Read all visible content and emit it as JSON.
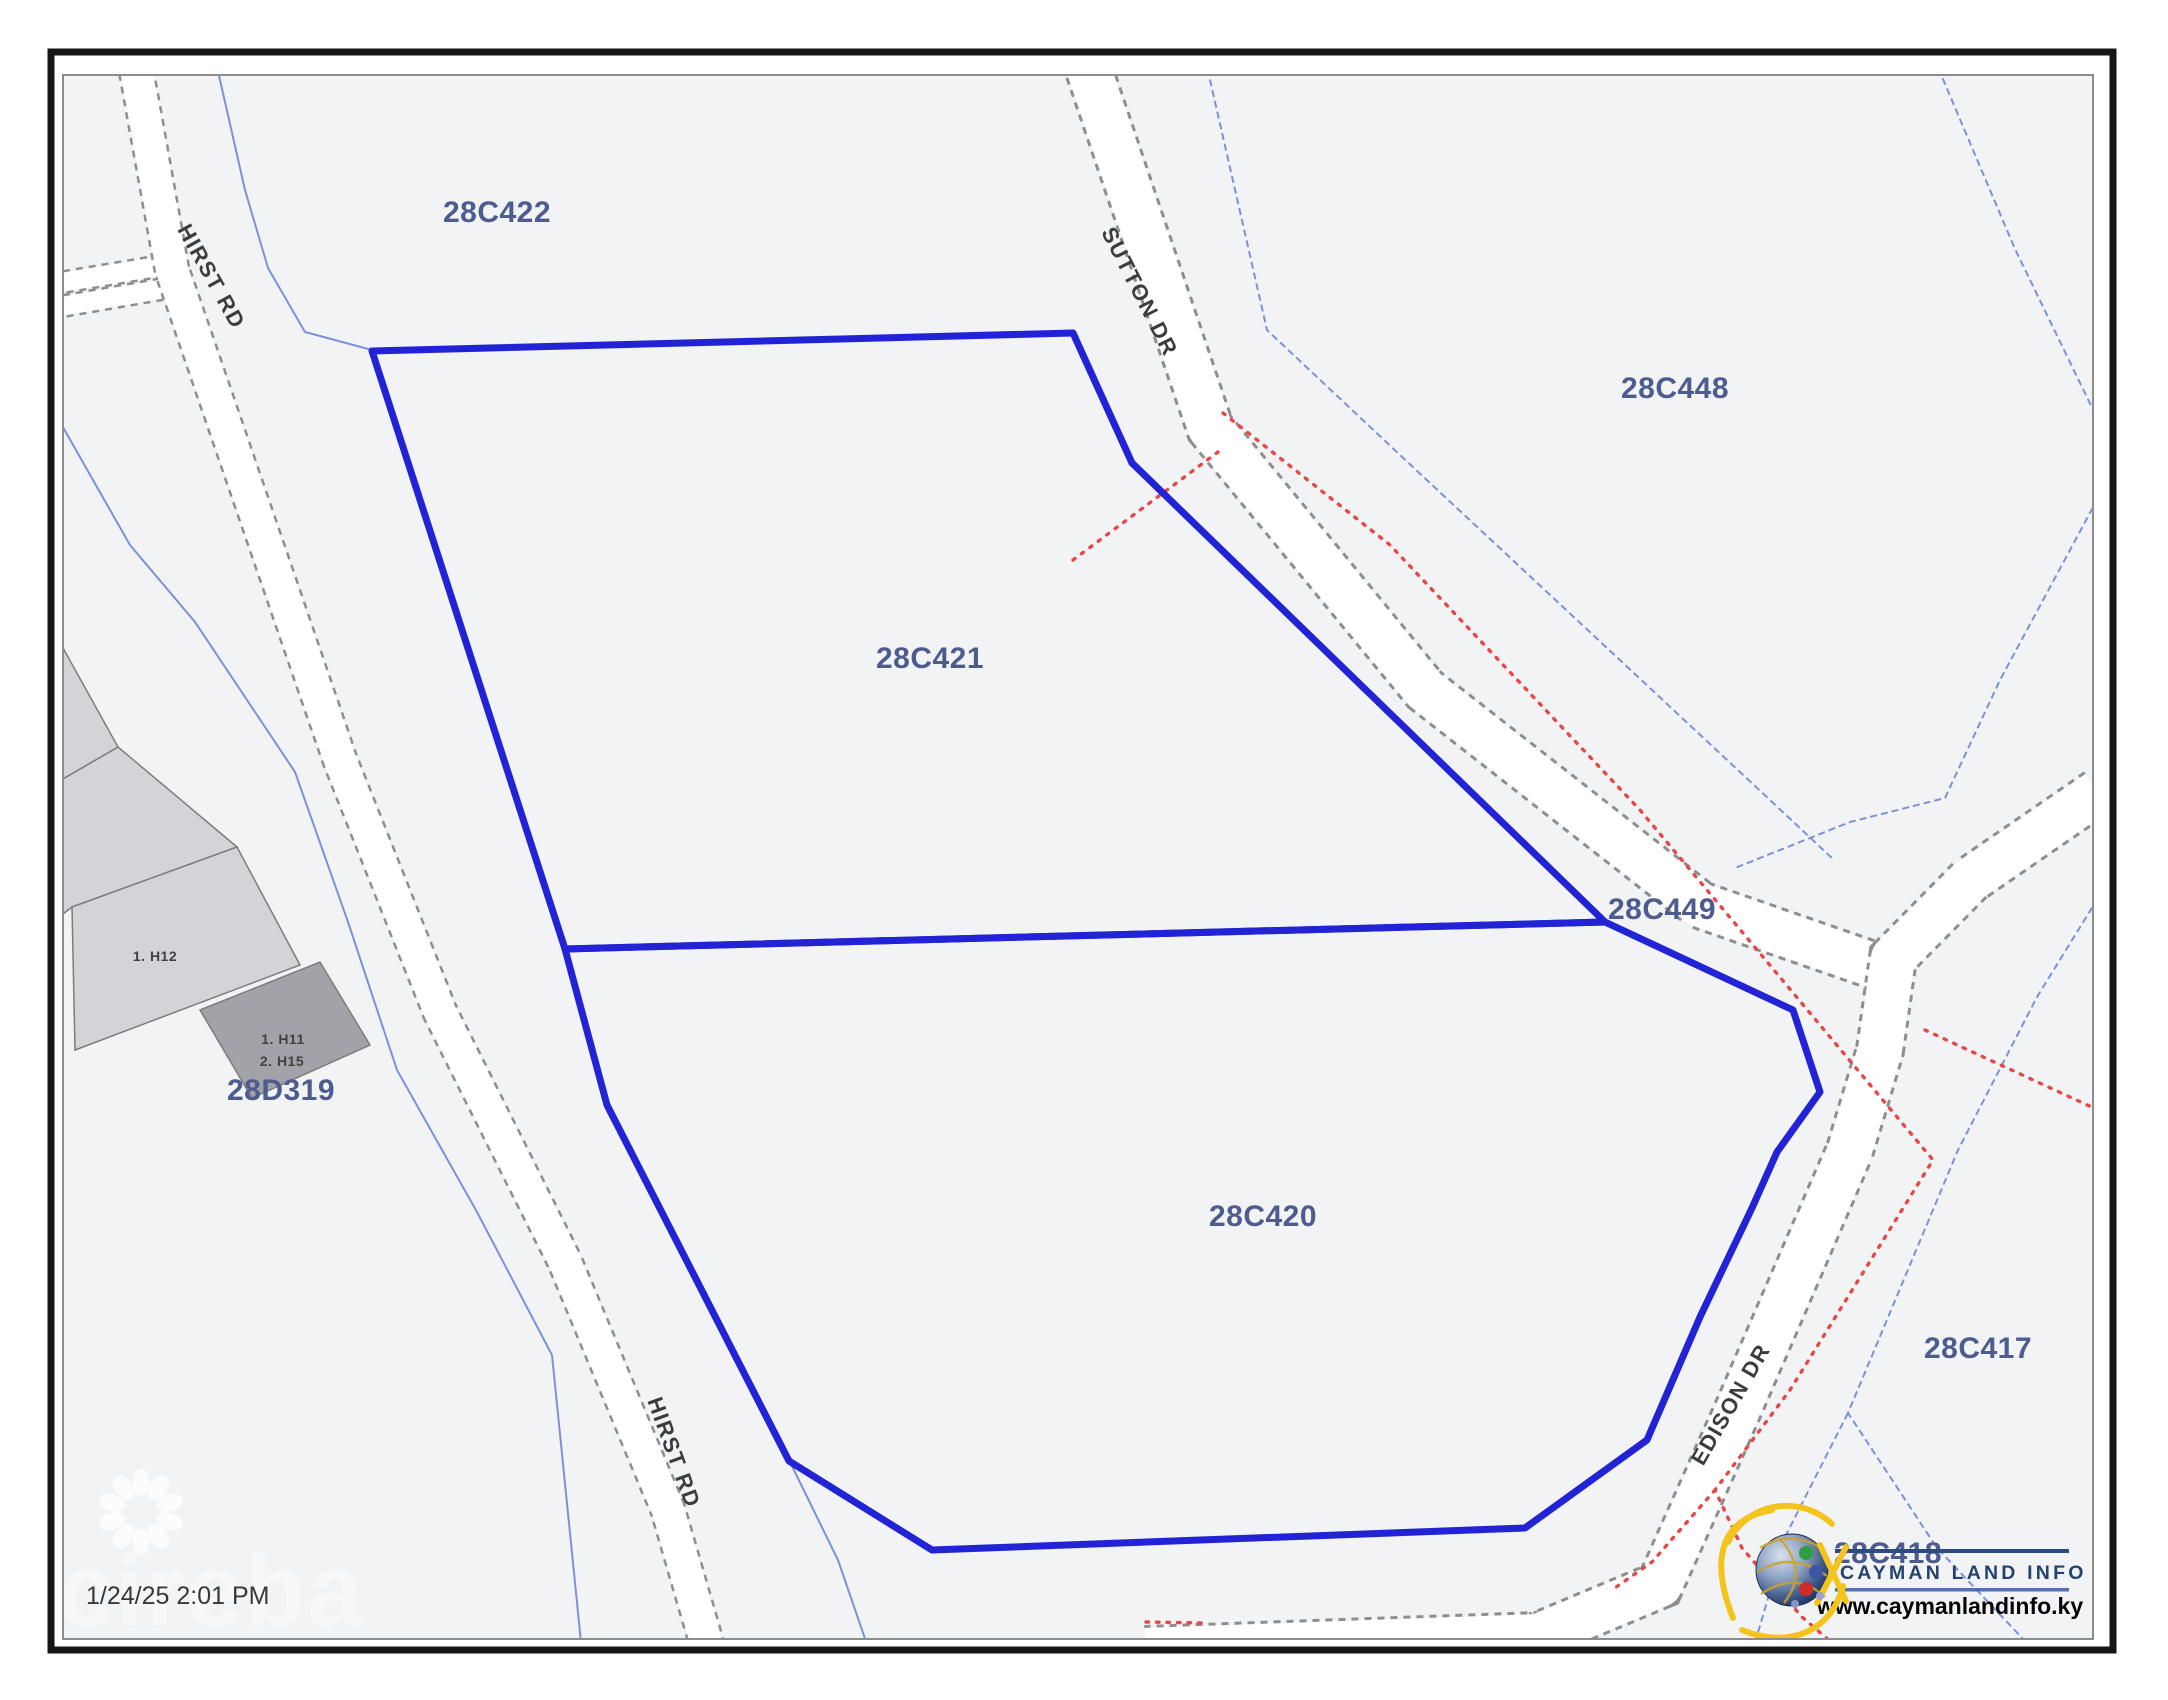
{
  "map": {
    "background": "#f2f3f5",
    "highlight_outline_color": "#2323d6",
    "boundary_line_color": "#7e91d8",
    "road_edge_color": "#8e8e8e",
    "red_dotted_color": "#e64747",
    "parcel_label_color": "#4d5b8e",
    "parcels": [
      {
        "id": "28C422"
      },
      {
        "id": "28C448"
      },
      {
        "id": "28C421"
      },
      {
        "id": "28C449"
      },
      {
        "id": "28C420"
      },
      {
        "id": "28C417"
      },
      {
        "id": "28C418"
      },
      {
        "id": "28D319"
      }
    ],
    "roads": [
      {
        "name": "HIRST RD"
      },
      {
        "name": "SUTTON DR"
      },
      {
        "name": "HIRST RD"
      },
      {
        "name": "EDISON DR"
      }
    ],
    "buildings": [
      {
        "label": "1. H12"
      },
      {
        "label": "1. H11"
      },
      {
        "label": "2. H15"
      }
    ],
    "timestamp": "1/24/25 2:01 PM",
    "watermark": "cireba"
  },
  "logo": {
    "title": "CAYMAN LAND INFO",
    "website": "www.caymanlandinfo.ky"
  }
}
